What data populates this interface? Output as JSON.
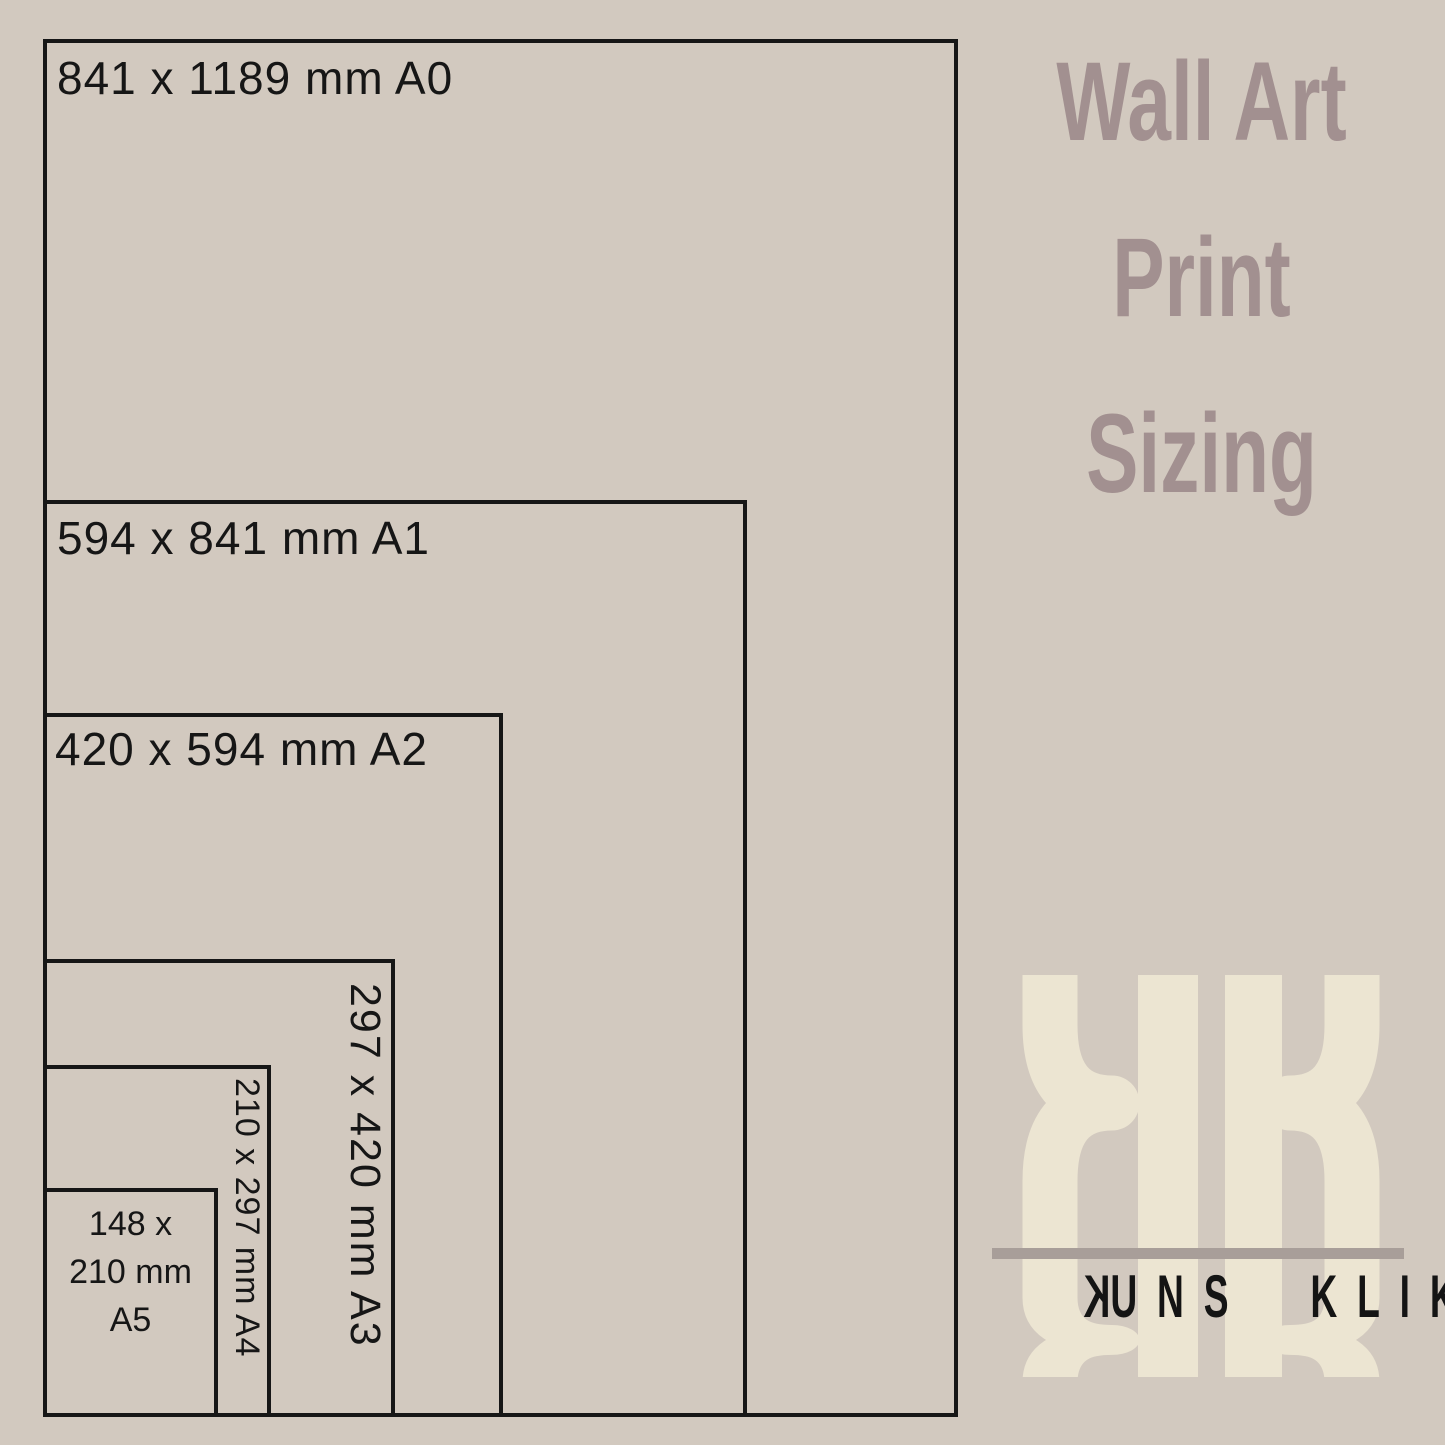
{
  "title": {
    "line1": "Wall Art",
    "line2": "Print",
    "line3": "Sizing"
  },
  "sizes": [
    {
      "code": "A0",
      "label": "841 x 1189 mm A0"
    },
    {
      "code": "A1",
      "label": "594 x 841 mm A1"
    },
    {
      "code": "A2",
      "label": "420 x 594 mm A2"
    },
    {
      "code": "A3",
      "label": "297 x 420 mm A3"
    },
    {
      "code": "A4",
      "label": "210 x 297 mm A4"
    },
    {
      "code": "A5",
      "lines": [
        "148 x",
        "210 mm",
        "A5"
      ]
    }
  ],
  "logo": {
    "monogram": "KK",
    "name_first_letter": "K",
    "name_rest": "UNS",
    "name_word2": "KLIK"
  },
  "colors": {
    "background": "#d2c9bf",
    "line": "#161616",
    "label_text": "#161616",
    "title_text": "#a29090",
    "logo_cream": "#ece5d2",
    "logo_bar": "#a89e99",
    "logo_text": "#141414"
  }
}
